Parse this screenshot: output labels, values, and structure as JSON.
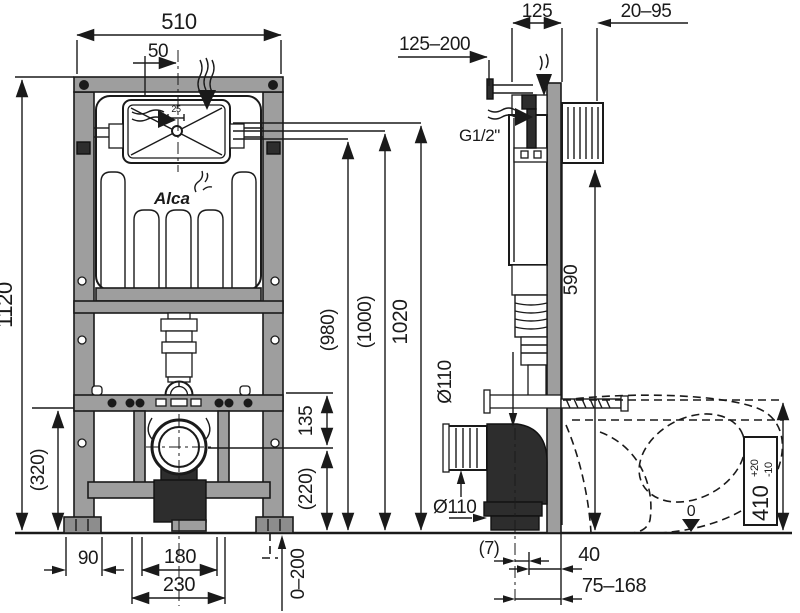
{
  "title": "concealed-wc-installation-frame-technical-drawing",
  "brand": {
    "logo": "Alca"
  },
  "front_view": {
    "dim_width_total": "510",
    "dim_valve_offset": "50",
    "dim_window_adjust": "25",
    "dim_height_total": "1120",
    "dim_lower_frame": "(320)",
    "dim_plate_height_1": "(980)",
    "dim_plate_height_2": "(1000)",
    "dim_plate_height_3": "1020",
    "dim_drain_to_bar": "135",
    "dim_drain_to_floor": "(220)",
    "dim_foot_width": "90",
    "dim_stud_spacing": "180",
    "dim_anchor_spacing": "230",
    "dim_leg_adjust": "0–200"
  },
  "side_view": {
    "dim_water_conn": "125–200",
    "dim_frame_depth": "125",
    "dim_covering": "20–95",
    "label_thread": "G1/2\"",
    "dim_plate_bottom": "590",
    "label_drain_dia_top": "Ø110",
    "label_drain_dia_bottom": "Ø110",
    "dim_outlet_gap": "(7)",
    "dim_outlet_40": "40",
    "dim_outlet_range": "75–168",
    "dim_seat_height": "410",
    "dim_seat_tol_plus": "+20",
    "dim_seat_tol_minus": "-10",
    "label_floor_zero": "0"
  }
}
